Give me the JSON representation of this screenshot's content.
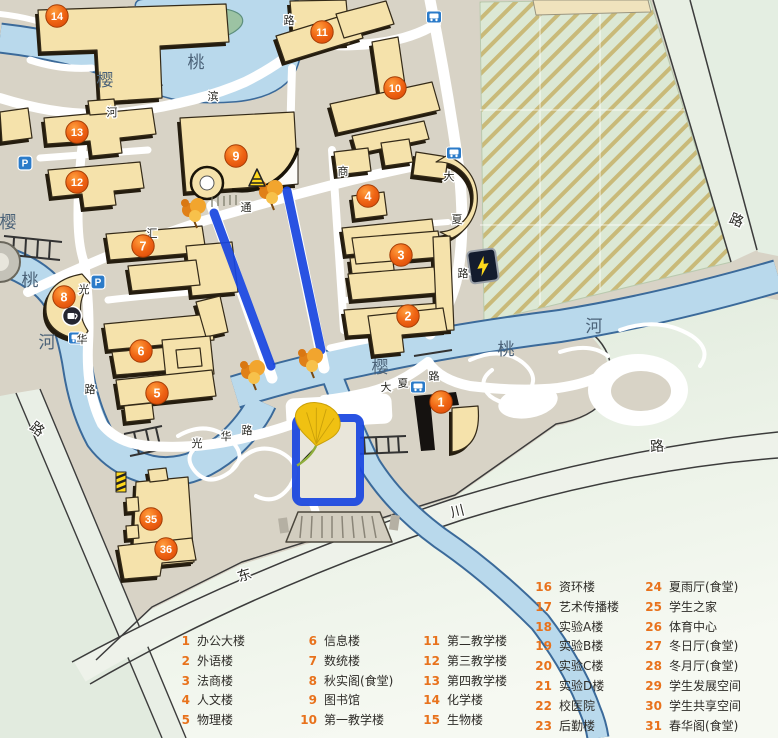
{
  "legend": {
    "items": [
      {
        "num": "1",
        "label": "办公大楼"
      },
      {
        "num": "2",
        "label": "外语楼"
      },
      {
        "num": "3",
        "label": "法商楼"
      },
      {
        "num": "4",
        "label": "人文楼"
      },
      {
        "num": "5",
        "label": "物理楼"
      },
      {
        "num": "6",
        "label": "信息楼"
      },
      {
        "num": "7",
        "label": "数统楼"
      },
      {
        "num": "8",
        "label": "秋实阁(食堂)"
      },
      {
        "num": "9",
        "label": "图书馆"
      },
      {
        "num": "10",
        "label": "第一教学楼"
      },
      {
        "num": "11",
        "label": "第二教学楼"
      },
      {
        "num": "12",
        "label": "第三教学楼"
      },
      {
        "num": "13",
        "label": "第四教学楼"
      },
      {
        "num": "14",
        "label": "化学楼"
      },
      {
        "num": "15",
        "label": "生物楼"
      },
      {
        "num": "16",
        "label": "资环楼"
      },
      {
        "num": "17",
        "label": "艺术传播楼"
      },
      {
        "num": "18",
        "label": "实验A楼"
      },
      {
        "num": "19",
        "label": "实验B楼"
      },
      {
        "num": "20",
        "label": "实验C楼"
      },
      {
        "num": "21",
        "label": "实验D楼"
      },
      {
        "num": "22",
        "label": "校医院"
      },
      {
        "num": "23",
        "label": "后勤楼"
      },
      {
        "num": "24",
        "label": "夏雨厅(食堂)"
      },
      {
        "num": "25",
        "label": "学生之家"
      },
      {
        "num": "26",
        "label": "体育中心"
      },
      {
        "num": "27",
        "label": "冬日厅(食堂)"
      },
      {
        "num": "28",
        "label": "冬月厅(食堂)"
      },
      {
        "num": "29",
        "label": "学生发展空间"
      },
      {
        "num": "30",
        "label": "学生共享空间"
      },
      {
        "num": "31",
        "label": "春华阁(食堂)"
      }
    ]
  },
  "markers": {
    "list": [
      {
        "n": "1"
      },
      {
        "n": "2"
      },
      {
        "n": "3"
      },
      {
        "n": "4"
      },
      {
        "n": "5"
      },
      {
        "n": "6"
      },
      {
        "n": "7"
      },
      {
        "n": "8"
      },
      {
        "n": "9"
      },
      {
        "n": "10"
      },
      {
        "n": "11"
      },
      {
        "n": "12"
      },
      {
        "n": "13"
      },
      {
        "n": "14"
      },
      {
        "n": "35"
      },
      {
        "n": "36"
      }
    ]
  },
  "map_labels": {
    "river_top_1": "樱",
    "river_top_2": "桃",
    "river_left_1": "樱",
    "river_left_2": "桃",
    "river_left_3": "河",
    "river_mid_1": "樱",
    "river_mid_2": "桃",
    "river_mid_3": "河",
    "road_hebin_1": "河",
    "road_hebin_2": "滨",
    "road_hebin_3": "路",
    "road_hui": "汇",
    "road_tong": "通",
    "road_shang": "商",
    "road_daxia_v_1": "大",
    "road_daxia_v_2": "夏",
    "road_daxia_v_3": "路",
    "road_daxia_h_1": "大",
    "road_daxia_h_2": "夏",
    "road_daxia_h_3": "路",
    "road_guanghua_v_1": "光",
    "road_guanghua_v_2": "华",
    "road_guanghua_v_3": "路",
    "road_guanghua_h_1": "光",
    "road_guanghua_h_2": "华",
    "road_guanghua_h_3": "路",
    "road_dongchuan_1": "东",
    "road_dongchuan_2": "川",
    "road_dongchuan_3": "路",
    "road_east": "路",
    "road_west": "路",
    "parking_1": "P",
    "parking_2": "P"
  },
  "icons": {
    "parking": "P-sign",
    "bus_stop": "bus",
    "coffee": "coffee-cup",
    "charging": "lightning",
    "warning_a": "a-frame-sign",
    "warning_pole": "striped-sign",
    "tree": "maple-tree",
    "ginkgo": "ginkgo-leaf"
  },
  "colors": {
    "marker": "#e95c14",
    "route": "#1946e0",
    "water": "#b9d9ec",
    "building": "#f5e2ab",
    "ground": "#d8d3c6",
    "green": "#dfe9db",
    "legend_num": "#e8721c"
  }
}
